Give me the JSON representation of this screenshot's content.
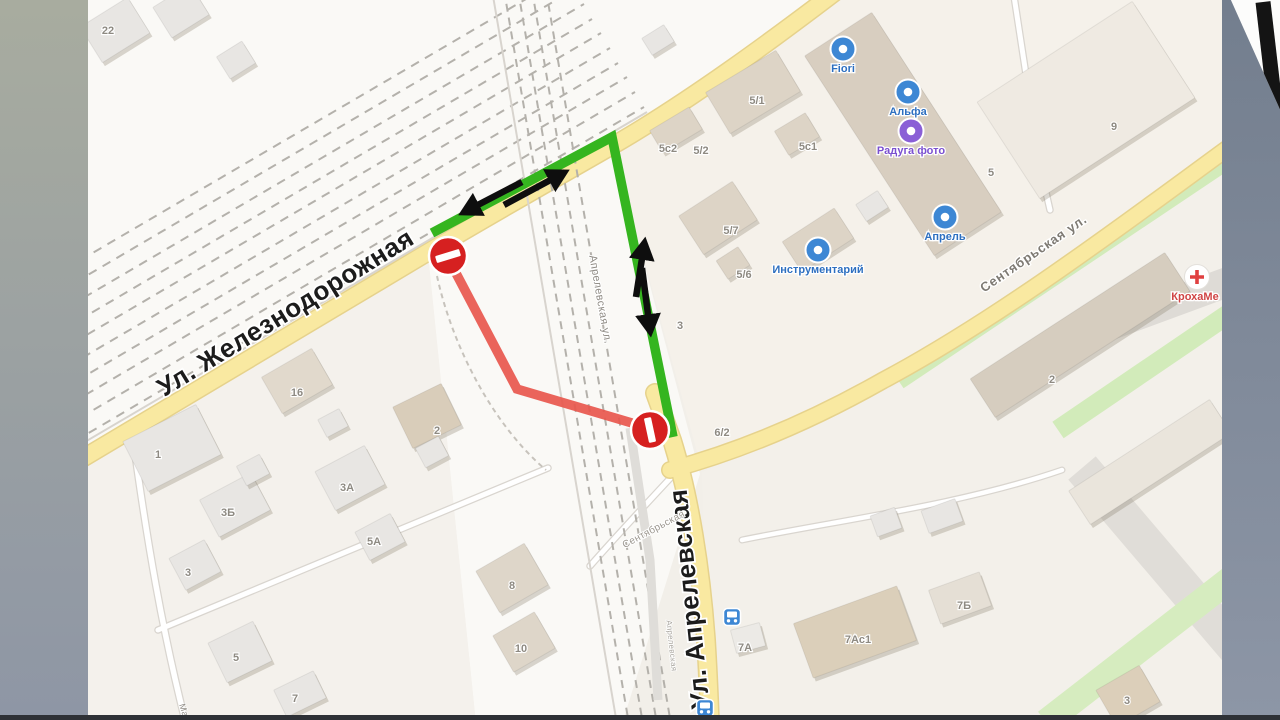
{
  "slide": {
    "left_band": {
      "width": 88,
      "top_color": "#a8ac9f",
      "bottom_color": "#8e96a5"
    },
    "right_band": {
      "x": 1222,
      "top_color": "#737e8e",
      "bottom_color": "#8d96a6"
    },
    "bottom_strip": {
      "y": 715,
      "height": 5,
      "color": "#2e3136"
    },
    "corner_paper": {
      "points": "1230,-2 1282,-2 1282,114",
      "fill": "#fcfcfb",
      "mark": {
        "x1": 1263,
        "y1": 2,
        "x2": 1276,
        "y2": 114,
        "width": 15,
        "color": "#141414"
      }
    }
  },
  "map": {
    "base": "#f2efe9",
    "clip": {
      "x": 88,
      "y": 0,
      "w": 1134,
      "h": 720
    },
    "zones": [
      {
        "name": "rail-yard",
        "points": "80,452 612,142 842,-12 80,-12",
        "fill": "#faf9f6"
      },
      {
        "name": "rail-corridor",
        "points": "428,254 612,142 700,474 622,724 476,724",
        "fill": "#faf9f6"
      },
      {
        "name": "block-north-east",
        "points": "612,142 842,-12 1226,-12 1226,150 898,382 702,470",
        "fill": "#f5f1ea"
      },
      {
        "name": "block-south-east",
        "points": "702,472 900,384 1226,152 1226,716 710,716",
        "fill": "#f3f0ea"
      },
      {
        "name": "block-south-west",
        "points": "80,456 428,256 476,724 80,724",
        "fill": "#f4f1ec"
      }
    ],
    "gray_bands": [
      {
        "path": "M 1048,348 L 1282,262",
        "width": 30,
        "color": "#dedbd6"
      },
      {
        "path": "M 1082,468 L 1254,670",
        "width": 36,
        "color": "#e0ddd8"
      }
    ],
    "green_strips": [
      {
        "path": "M 898,380 L 1232,156",
        "width": 20,
        "color": "#d2ebba"
      },
      {
        "path": "M 1058,430 L 1252,298",
        "width": 20,
        "color": "#d2ebba"
      },
      {
        "path": "M 1046,722 L 1242,570",
        "width": 26,
        "color": "#d6ecbf"
      }
    ],
    "minor_roads": [
      {
        "path": "M 134,446 C 147,540 162,630 186,724",
        "width": 5.5
      },
      {
        "path": "M 158,630 L 548,468",
        "width": 5
      },
      {
        "path": "M 676,472 C 648,502 620,532 590,566",
        "width": 5
      },
      {
        "path": "M 1014,-4 L 1040,166 L 1050,210",
        "width": 5
      },
      {
        "path": "M 742,540 C 840,520 960,505 1062,470",
        "width": 4.5
      }
    ],
    "footpaths": [
      {
        "path": "M 437,276 C 452,345 492,424 546,470"
      }
    ],
    "yellow_roads": {
      "fill": "#f9e9a1",
      "casing": "#e6d28c",
      "segments": [
        {
          "name": "zheleznodorozhnaya",
          "path": "M 80,460 L 430,251 C 520,198 560,176 612,146 C 690,101 775,38 838,-10",
          "width": 16
        },
        {
          "name": "aprelevskaya",
          "path": "M 655,393 L 672,440 C 690,498 701,570 706,640 C 708,672 709,696 710,724",
          "width": 17
        },
        {
          "name": "sentyabrskaya",
          "path": "M 670,470 C 736,452 806,424 882,381 C 1000,318 1124,224 1228,148",
          "width": 15
        }
      ]
    },
    "rail_yard_lines": {
      "solid_color": "#d8d4ce",
      "dash_color": "#b4b1ab",
      "solid": [
        [
          78,
          446,
          647,
          112
        ]
      ],
      "dashed": [
        [
          75,
          441,
          644,
          107
        ],
        [
          66,
          426,
          635,
          92
        ],
        [
          58,
          411,
          627,
          77
        ],
        [
          49,
          397,
          618,
          63
        ],
        [
          41,
          382,
          610,
          48
        ],
        [
          32,
          367,
          601,
          33
        ],
        [
          23,
          353,
          592,
          19
        ],
        [
          15,
          338,
          584,
          4
        ],
        [
          6,
          323,
          575,
          -11
        ],
        [
          -3,
          309,
          567,
          -25
        ]
      ]
    },
    "rail_main": {
      "solid": [
        [
          492,
          -10,
          618,
          730
        ]
      ],
      "dashed": [
        [
          504,
          -10,
          630,
          730
        ],
        [
          518,
          -10,
          644,
          730
        ],
        [
          532,
          -10,
          658,
          730
        ],
        [
          546,
          -10,
          672,
          730
        ]
      ],
      "platform": "M 630,428 L 650,560 L 658,700"
    },
    "buildings": [
      [
        115,
        30,
        56,
        42,
        -32,
        "#e8e6e3"
      ],
      [
        181,
        11,
        44,
        36,
        -32,
        "#e8e6e3"
      ],
      [
        236,
        60,
        30,
        26,
        -32,
        "#e8e6e3"
      ],
      [
        658,
        40,
        26,
        20,
        -32,
        "#e8e6e3"
      ],
      [
        297,
        381,
        58,
        42,
        -30,
        "#e1d9cc"
      ],
      [
        427,
        416,
        54,
        46,
        -26,
        "#d9cdba"
      ],
      [
        172,
        448,
        82,
        56,
        -27,
        "#e8e6e3"
      ],
      [
        235,
        505,
        58,
        42,
        -28,
        "#e8e6e3"
      ],
      [
        350,
        478,
        56,
        44,
        -28,
        "#e8e6e3"
      ],
      [
        380,
        537,
        40,
        32,
        -28,
        "#e8e6e3"
      ],
      [
        195,
        565,
        40,
        36,
        -28,
        "#e8e6e3"
      ],
      [
        240,
        652,
        50,
        44,
        -26,
        "#e8e6e3"
      ],
      [
        300,
        694,
        44,
        30,
        -26,
        "#e8e6e3"
      ],
      [
        512,
        578,
        56,
        48,
        -30,
        "#ded6c9"
      ],
      [
        524,
        642,
        48,
        42,
        -30,
        "#ded6c9"
      ],
      [
        253,
        470,
        26,
        22,
        -28,
        "#e8e6e3"
      ],
      [
        432,
        452,
        26,
        22,
        -28,
        "#e8e6e3"
      ],
      [
        333,
        423,
        24,
        20,
        -28,
        "#e8e6e3"
      ],
      [
        903,
        134,
        80,
        238,
        -33,
        "#d8cec0"
      ],
      [
        753,
        92,
        82,
        48,
        -31,
        "#ddd4c6"
      ],
      [
        676,
        130,
        46,
        26,
        -31,
        "#ddd4c6"
      ],
      [
        797,
        134,
        36,
        28,
        -31,
        "#ddd4c6"
      ],
      [
        1086,
        100,
        185,
        115,
        -33,
        "#efeae2"
      ],
      [
        718,
        218,
        64,
        46,
        -33,
        "#ddd4c6"
      ],
      [
        733,
        263,
        26,
        22,
        -33,
        "#ddd4c6"
      ],
      [
        818,
        240,
        62,
        36,
        -33,
        "#ddd4c6"
      ],
      [
        872,
        206,
        26,
        20,
        -33,
        "#e8e6e3"
      ],
      [
        1080,
        335,
        232,
        46,
        -33,
        "#d6cdbf"
      ],
      [
        1150,
        462,
        168,
        40,
        -33,
        "#eae5dc"
      ],
      [
        855,
        632,
        110,
        58,
        -20,
        "#dbcfba"
      ],
      [
        960,
        598,
        54,
        36,
        -20,
        "#e5dfd5"
      ],
      [
        1128,
        696,
        50,
        42,
        -30,
        "#dccfba"
      ],
      [
        886,
        522,
        26,
        22,
        -20,
        "#e8e6e3"
      ],
      [
        942,
        516,
        36,
        24,
        -20,
        "#e8e6e3"
      ],
      [
        748,
        638,
        30,
        24,
        -15,
        "#eceae6"
      ]
    ],
    "building_labels": [
      {
        "text": "22",
        "x": 108,
        "y": 34
      },
      {
        "text": "16",
        "x": 297,
        "y": 396
      },
      {
        "text": "2",
        "x": 437,
        "y": 434
      },
      {
        "text": "1",
        "x": 158,
        "y": 458
      },
      {
        "text": "3Б",
        "x": 228,
        "y": 516
      },
      {
        "text": "3А",
        "x": 347,
        "y": 491
      },
      {
        "text": "5А",
        "x": 374,
        "y": 545
      },
      {
        "text": "3",
        "x": 188,
        "y": 576
      },
      {
        "text": "5",
        "x": 236,
        "y": 661
      },
      {
        "text": "7",
        "x": 295,
        "y": 702
      },
      {
        "text": "8",
        "x": 512,
        "y": 589
      },
      {
        "text": "10",
        "x": 521,
        "y": 652
      },
      {
        "text": "5/1",
        "x": 757,
        "y": 104
      },
      {
        "text": "5с2",
        "x": 668,
        "y": 152
      },
      {
        "text": "5/2",
        "x": 701,
        "y": 154
      },
      {
        "text": "5с1",
        "x": 808,
        "y": 150
      },
      {
        "text": "5",
        "x": 991,
        "y": 176
      },
      {
        "text": "9",
        "x": 1114,
        "y": 130
      },
      {
        "text": "5/7",
        "x": 731,
        "y": 234
      },
      {
        "text": "5/6",
        "x": 744,
        "y": 278
      },
      {
        "text": "3",
        "x": 680,
        "y": 329
      },
      {
        "text": "6/2",
        "x": 722,
        "y": 436
      },
      {
        "text": "7А",
        "x": 745,
        "y": 651
      },
      {
        "text": "7Б",
        "x": 964,
        "y": 609
      },
      {
        "text": "7Ас1",
        "x": 858,
        "y": 643
      },
      {
        "text": "3",
        "x": 1127,
        "y": 704
      },
      {
        "text": "2",
        "x": 1052,
        "y": 383
      }
    ],
    "street_labels": [
      {
        "text": "Ул. Железнодорожная",
        "x": 290,
        "y": 320,
        "rot": -31.5,
        "size": 26,
        "weight": 800,
        "color": "#1c1c1c",
        "halo": 3.5,
        "ls": 0.5
      },
      {
        "text": "Ул. Апрелевская",
        "x": 698,
        "y": 598,
        "rot": -96,
        "size": 26,
        "weight": 800,
        "color": "#1c1c1c",
        "halo": 3.5,
        "ls": 0.5
      },
      {
        "text": "Сентябрьская ул.",
        "x": 1036,
        "y": 257,
        "rot": -34.5,
        "size": 13,
        "weight": 600,
        "color": "#7e7a73",
        "halo": 2.5,
        "ls": 0.8
      },
      {
        "text": "Апрелевская ул.",
        "x": 597,
        "y": 300,
        "rot": 80,
        "size": 11,
        "weight": 500,
        "color": "#8f8b84",
        "halo": 2,
        "ls": 0.4
      },
      {
        "text": "Сентябрьская",
        "x": 655,
        "y": 532,
        "rot": -28,
        "size": 10,
        "weight": 500,
        "color": "#9b968e",
        "halo": 2,
        "ls": 0.3
      },
      {
        "text": "Апрелевская",
        "x": 669,
        "y": 646,
        "rot": 84,
        "size": 8,
        "weight": 500,
        "color": "#a9a59e",
        "halo": 1.5,
        "ls": 0.3
      },
      {
        "text": "Ма",
        "x": 181,
        "y": 711,
        "rot": 72,
        "size": 9,
        "weight": 500,
        "color": "#8f8b84",
        "halo": 1.5,
        "ls": 0.3
      }
    ],
    "pois": [
      {
        "label": "Fiori",
        "x": 843,
        "y": 49,
        "icon": "flower-shop",
        "color": "#3d87d4",
        "label_color": "#2d6fc0"
      },
      {
        "label": "Альфа",
        "x": 908,
        "y": 92,
        "icon": "shop",
        "color": "#3d87d4",
        "label_color": "#2d6fc0"
      },
      {
        "label": "Радуга фото",
        "x": 911,
        "y": 131,
        "icon": "photo",
        "color": "#8a5fd6",
        "label_color": "#7a4fd0"
      },
      {
        "label": "Апрель",
        "x": 945,
        "y": 217,
        "icon": "pharmacy",
        "color": "#3d87d4",
        "label_color": "#2d6fc0"
      },
      {
        "label": "Инструментарий",
        "x": 818,
        "y": 250,
        "icon": "tools",
        "color": "#3d87d4",
        "label_color": "#2d6fc0"
      },
      {
        "label": "КрохаМе",
        "x": 1197,
        "y": 277,
        "icon": "medical-cross",
        "color": "#ffffff",
        "label_color": "#d04545"
      }
    ],
    "train_icons": [
      {
        "x": 732,
        "y": 617
      },
      {
        "x": 705,
        "y": 708
      }
    ],
    "overlay": {
      "detour_color": "#35b51f",
      "closed_color": "#e8574d",
      "detour_points": "432,233 612,137 673,437",
      "closed_points": "448,258 517,389 649,428",
      "route_width": 9.5,
      "arrow_color": "#0e0e0e",
      "arrows": [
        {
          "x1": 504,
          "y1": 205,
          "x2": 556,
          "y2": 177
        },
        {
          "x1": 522,
          "y1": 182,
          "x2": 472,
          "y2": 208
        },
        {
          "x1": 636,
          "y1": 297,
          "x2": 643,
          "y2": 252
        },
        {
          "x1": 642,
          "y1": 268,
          "x2": 649,
          "y2": 322
        }
      ],
      "signs": [
        {
          "x": 448,
          "y": 256,
          "bar_rot": -17
        },
        {
          "x": 650,
          "y": 430,
          "bar_rot": 78
        }
      ],
      "sign_color": "#d62020",
      "sign_radius": 19
    }
  }
}
